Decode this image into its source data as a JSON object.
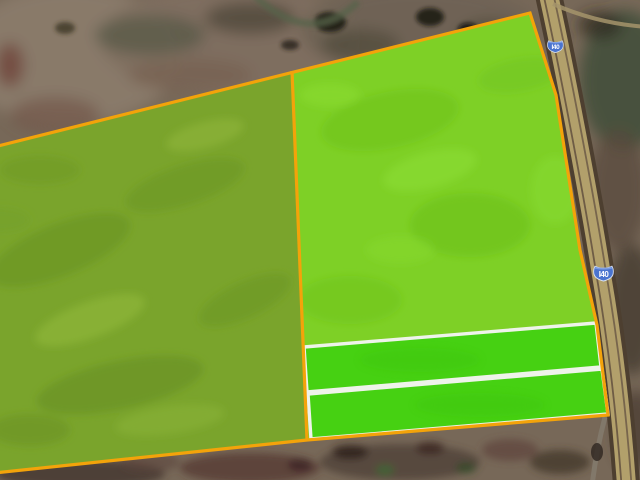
{
  "map": {
    "title": "Satellite parcel view along Interstate 40",
    "imagery_type": "satellite",
    "shields": [
      {
        "label": "I40"
      },
      {
        "label": "I40"
      }
    ],
    "parcels": [
      {
        "id": "west-parcel",
        "fill": "#7aa42c",
        "outline": "#f3a30a"
      },
      {
        "id": "east-parcel",
        "fill": "#7ed026",
        "outline": "#f3a30a"
      },
      {
        "id": "strip-parcel-1",
        "fill": "#46d112",
        "outline": "#eef3ea"
      },
      {
        "id": "strip-parcel-2",
        "fill": "#46d112",
        "outline": "#eef3ea"
      }
    ],
    "colors": {
      "boundary_orange": "#f3a30a",
      "strip_white": "#eef3ea",
      "road_tan": "#b2a06b",
      "road_casing": "#4d3f30",
      "shield_blue": "#4a74cf",
      "terrain_base": "#776858"
    }
  }
}
